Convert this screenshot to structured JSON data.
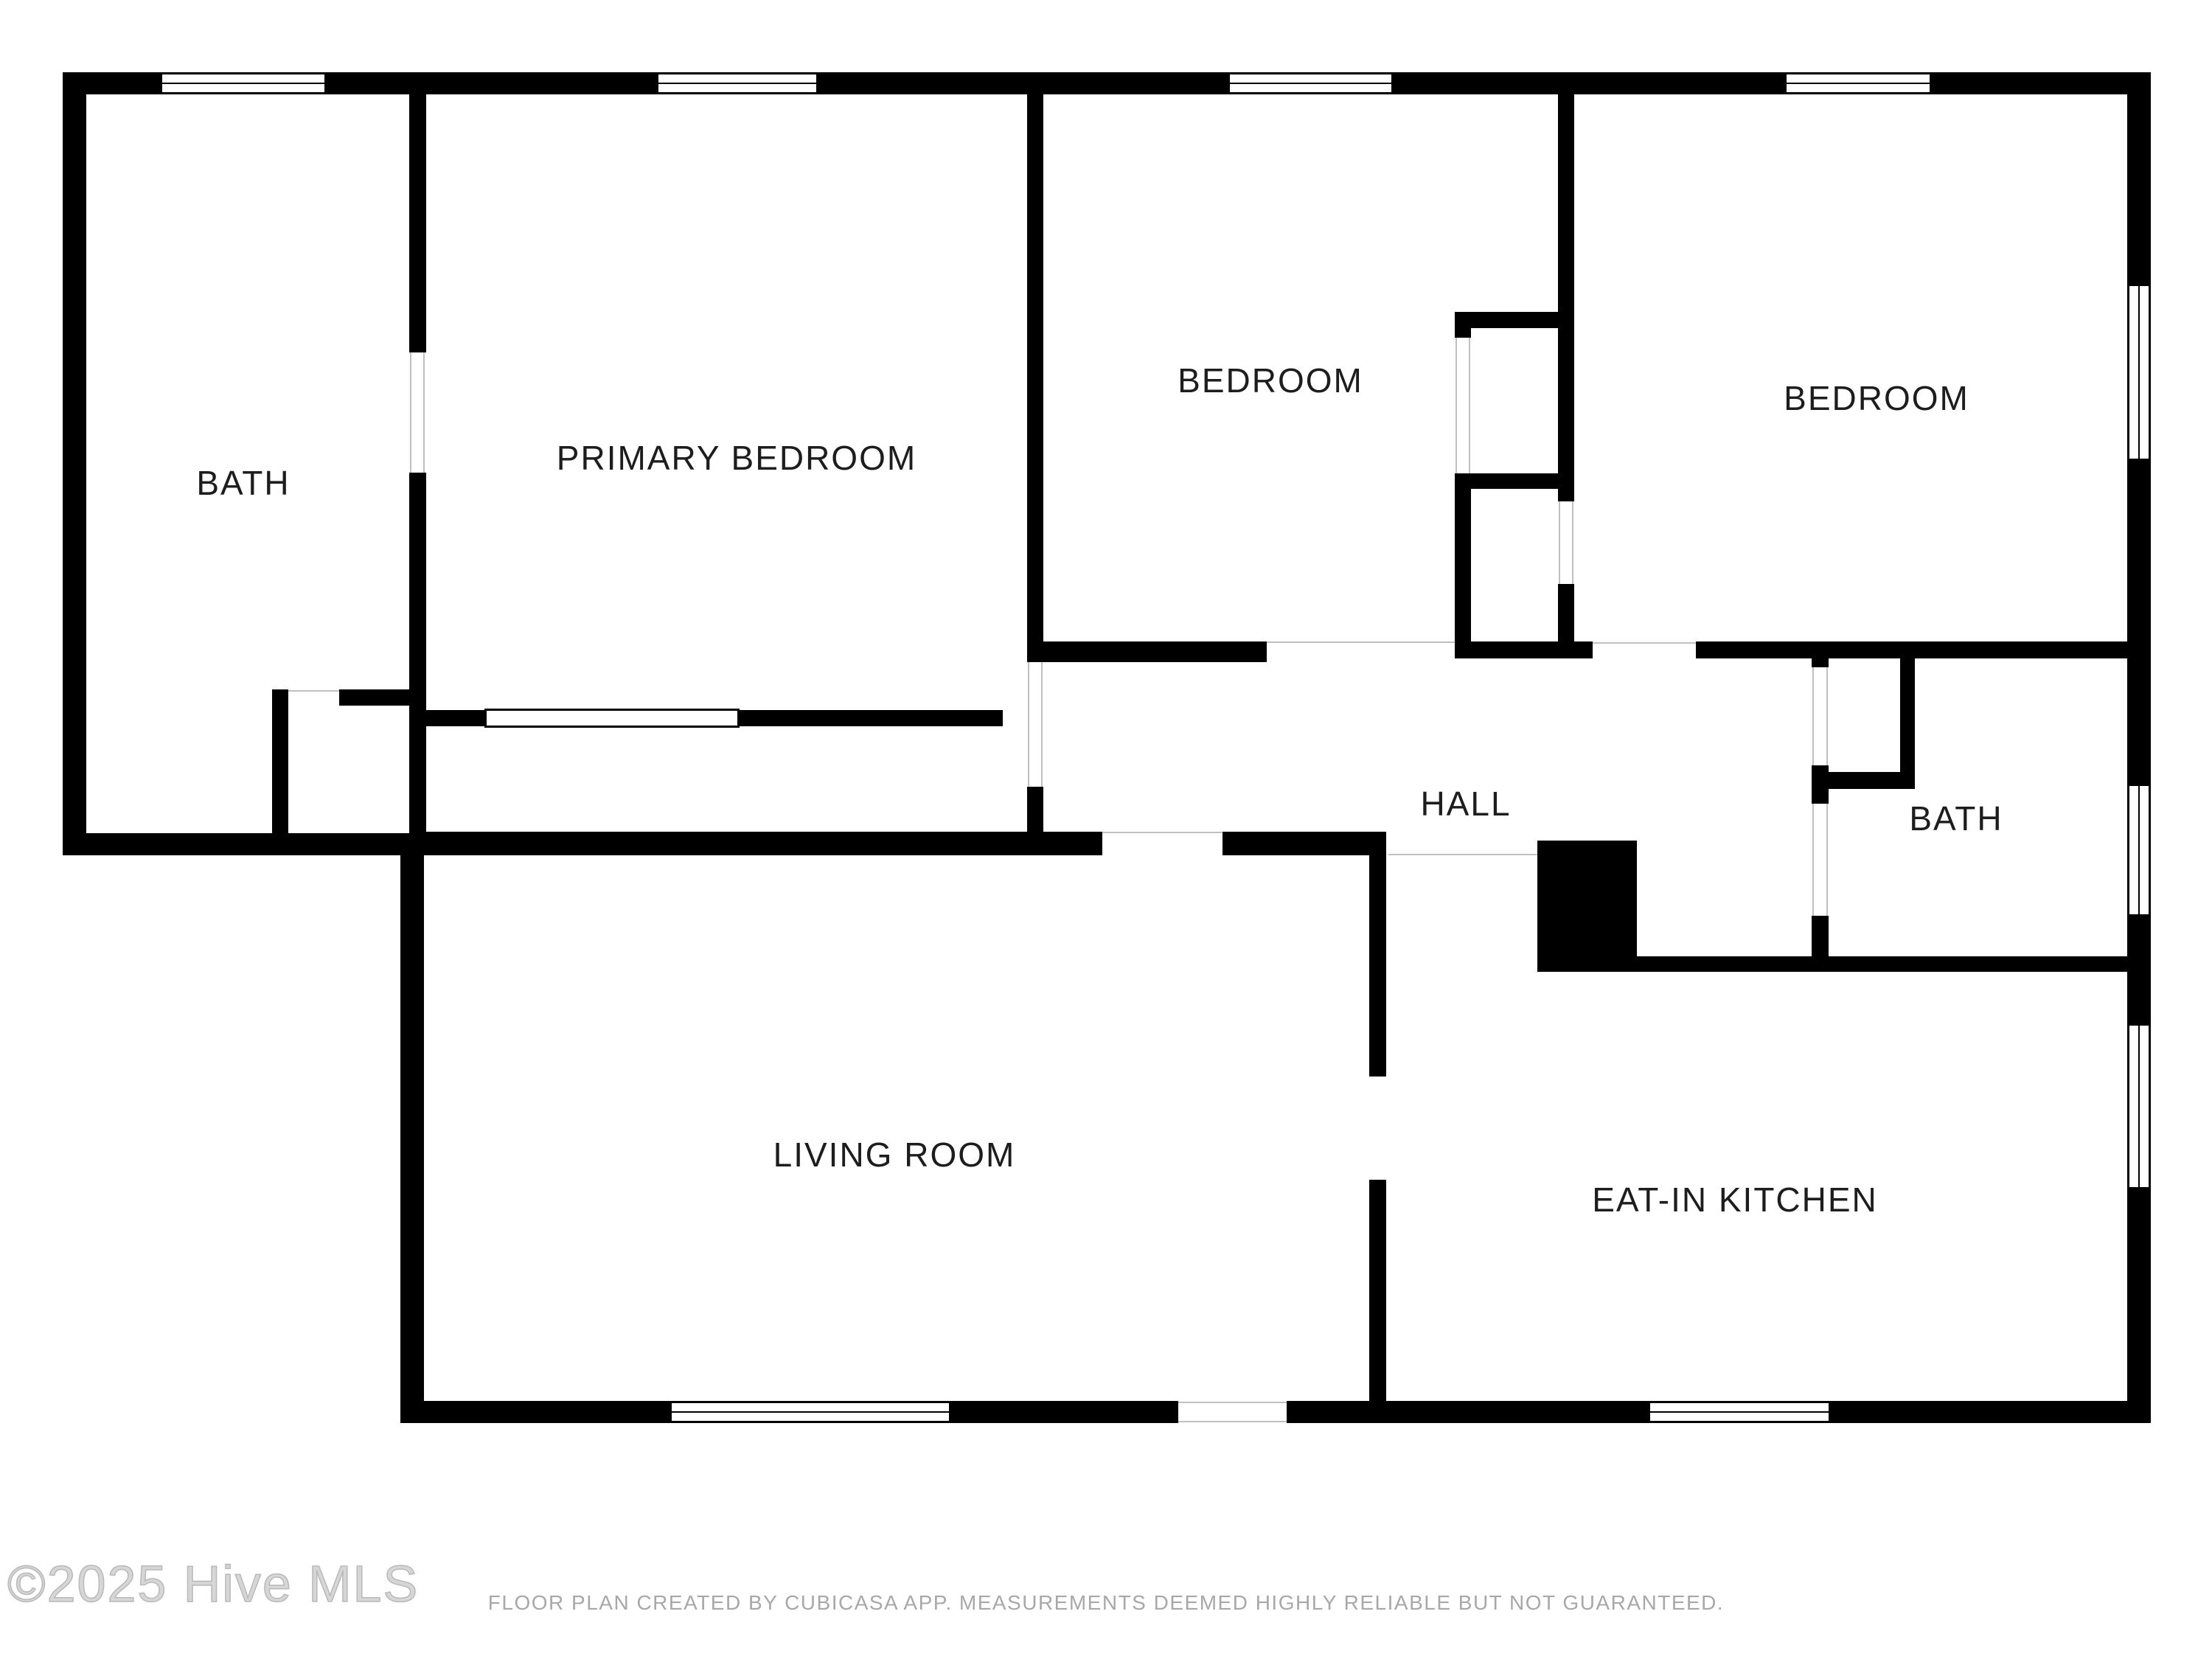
{
  "plan": {
    "rooms": [
      {
        "id": "bath-left",
        "label": "BATH"
      },
      {
        "id": "primary-bedroom",
        "label": "PRIMARY BEDROOM"
      },
      {
        "id": "bedroom-middle",
        "label": "BEDROOM"
      },
      {
        "id": "bedroom-right",
        "label": "BEDROOM"
      },
      {
        "id": "hall",
        "label": "HALL"
      },
      {
        "id": "bath-right",
        "label": "BATH"
      },
      {
        "id": "living-room",
        "label": "LIVING ROOM"
      },
      {
        "id": "eat-in-kitchen",
        "label": "EAT-IN KITCHEN"
      }
    ],
    "features": {
      "window_count": 9,
      "solid_block": "chimney-stair-block"
    }
  },
  "footer": {
    "watermark": "©2025 Hive MLS",
    "disclaimer": "FLOOR PLAN CREATED BY CUBICASA APP. MEASUREMENTS DEEMED HIGHLY RELIABLE BUT NOT GUARANTEED."
  },
  "colors": {
    "wall": "#000000",
    "background": "#ffffff",
    "room_label": "#1d1d1d",
    "hairline": "#c0c0c0",
    "watermark": "#c9c9c9",
    "disclaimer": "#a8a8a8"
  }
}
